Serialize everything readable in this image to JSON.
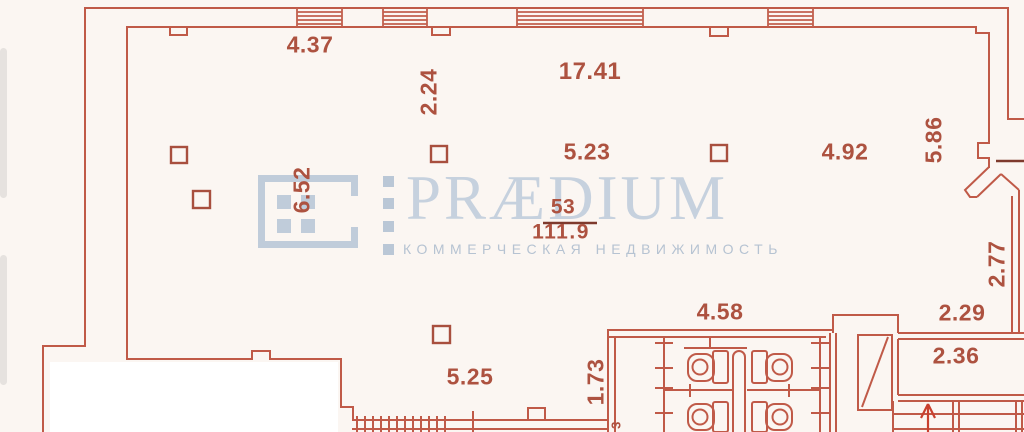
{
  "watermark": {
    "brand": "PRÆDIUM",
    "tagline": "КОММЕРЧЕСКАЯ НЕДВИЖИМОСТЬ",
    "color": "#c0ccda"
  },
  "room": {
    "number": "53",
    "area": "111.9"
  },
  "dims": {
    "top_window": "4.37",
    "hall_width": "17.41",
    "pier_depth": "2.24",
    "span_left": "5.23",
    "span_right": "4.92",
    "depth_right": "5.86",
    "span_mid": "6.52",
    "wall_right": "2.77",
    "wc_width": "4.58",
    "niche_a": "2.29",
    "niche_b": "2.36",
    "span_bottom": "5.25",
    "wc_depth": "1.73",
    "partial_digit": "3"
  },
  "colors": {
    "wall_line": "#c05a48",
    "dark_line": "#7e3a2d",
    "label_text": "#ad5240",
    "column_marker": "#a84f3e",
    "stairs_arrow": "#c9402e",
    "background": "#fbf6f2",
    "cover": "#ffffff"
  }
}
